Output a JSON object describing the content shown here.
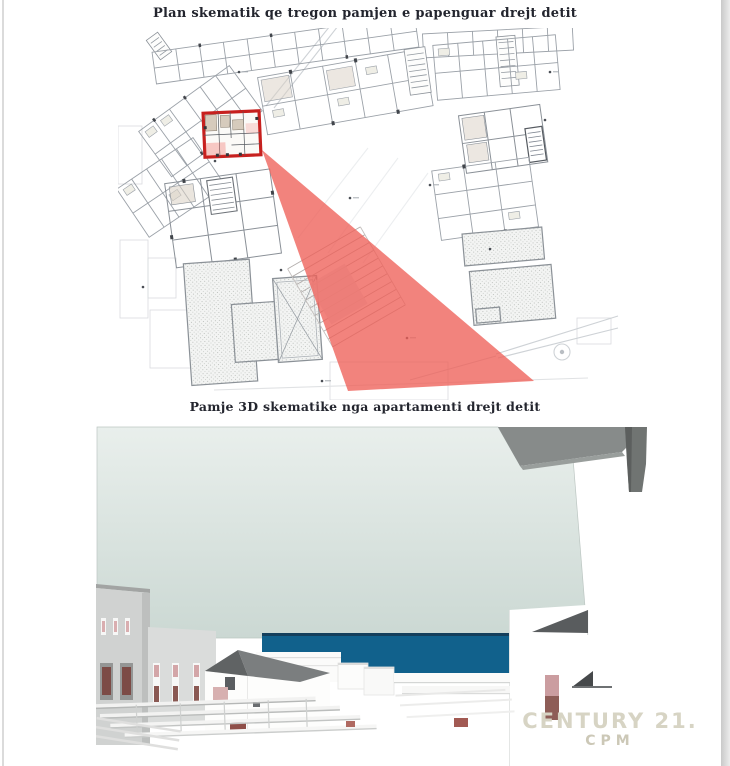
{
  "plan_section": {
    "title": "Plan skematik qe tregon pamjen e papenguar drejt detit",
    "description": "site-floor-plan-with-highlighted-apartment-and-sea-view-cone"
  },
  "render_section": {
    "title": "Pamje 3D skematike nga apartamenti drejt detit",
    "description": "3d-schematic-sea-view-from-apartment"
  },
  "watermark": {
    "brand": "CENTURY 21.",
    "sub": "CPM"
  },
  "colors": {
    "view_cone": "#ee6058",
    "highlight_box": "#c7201e",
    "sea": "#11618c",
    "sea_horizon": "#143f5c",
    "sky_top": "#e9efec",
    "sky_bottom": "#cbd8d3",
    "plan_line": "#9ba1a8",
    "watermark": "#d7d4c4"
  }
}
